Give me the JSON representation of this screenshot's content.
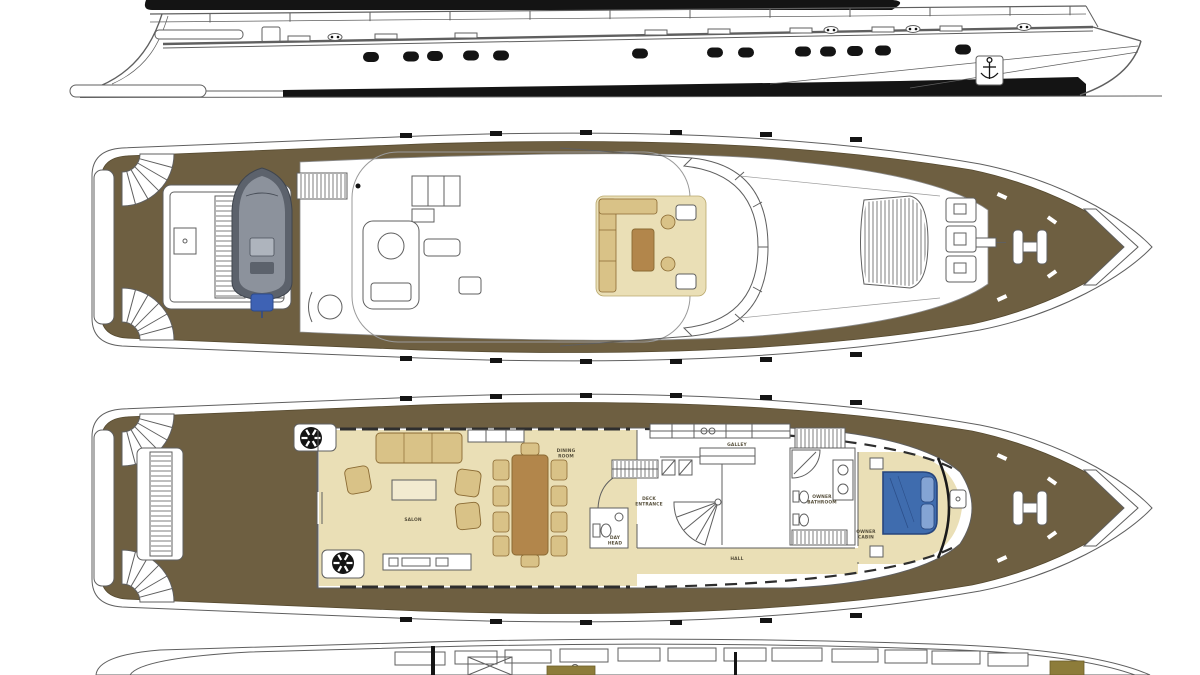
{
  "colors": {
    "white": "#ffffff",
    "line": "#5f5f5f",
    "ink": "#141414",
    "deck_brown": "#6e5f41",
    "floor_tan": "#eadfb6",
    "furniture_tan": "#d9c287",
    "table_brown": "#b2864b",
    "bed_blue": "#3f6cae",
    "pillow_blue": "#84a4d4",
    "tender_gray": "#8c929c",
    "tender_dark": "#5c626c",
    "engine_blue": "#3e62b4",
    "hatch_olive": "#8d7c3a",
    "label_color": "#57503c"
  },
  "labels": {
    "salon": "SALON",
    "dining_room": [
      "DINING",
      "ROOM"
    ],
    "galley": "GALLEY",
    "hall": "HALL",
    "day_head": [
      "DAY",
      "HEAD"
    ],
    "deck_entrance": [
      "DECK",
      "ENTRANCE"
    ],
    "owner_bathroom": [
      "OWNER",
      "BATHROOM"
    ],
    "owner_cabin": [
      "OWNER",
      "CABIN"
    ]
  }
}
